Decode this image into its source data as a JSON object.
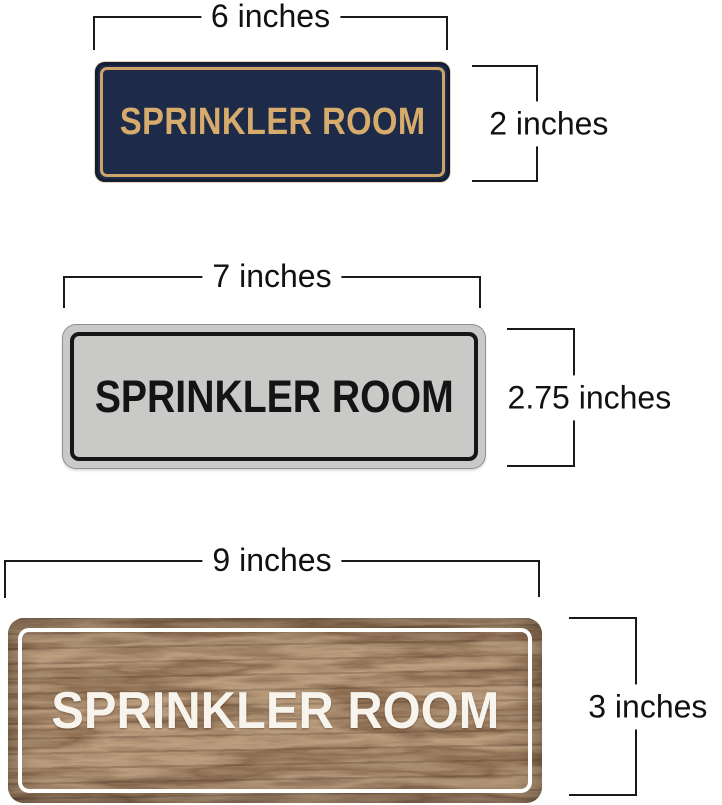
{
  "annotation": {
    "line_color": "#1a1a1a",
    "text_color": "#111111"
  },
  "signs": [
    {
      "name": "navy-gold-sign",
      "text": "SPRINKLER ROOM",
      "width_label": "6 inches",
      "height_label": "2 inches",
      "colors": {
        "panel": "#1d2b49",
        "pinstripe": "#cda465",
        "text": "#d6ab6c"
      }
    },
    {
      "name": "silver-black-sign",
      "text": "SPRINKLER ROOM",
      "width_label": "7 inches",
      "height_label": "2.75 inches",
      "colors": {
        "panel": "#c9c9c7",
        "border": "#161616",
        "text": "#141414"
      }
    },
    {
      "name": "walnut-white-sign",
      "text": "SPRINKLER ROOM",
      "width_label": "9 inches",
      "height_label": "3 inches",
      "colors": {
        "panel": "#4a3423",
        "border": "#ffffff",
        "text": "#f7f3ed"
      }
    }
  ]
}
